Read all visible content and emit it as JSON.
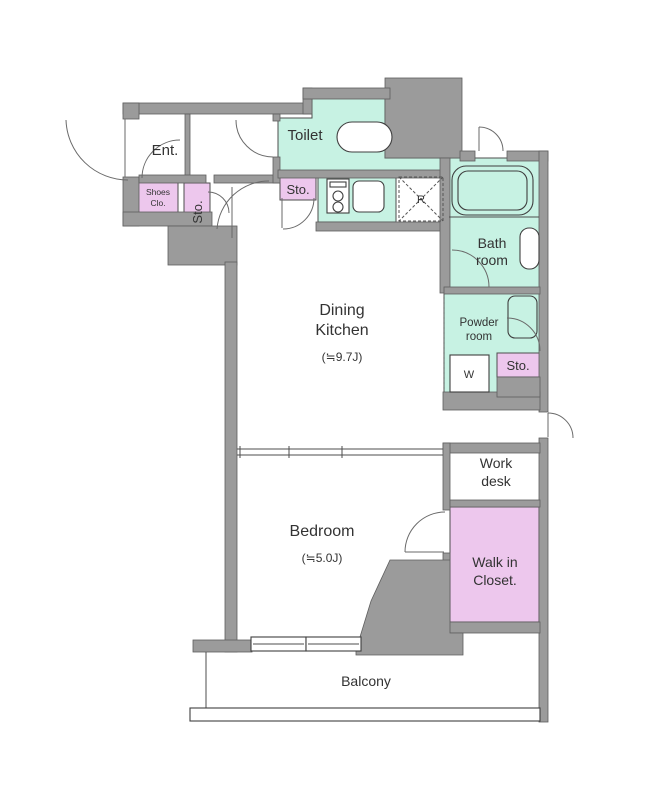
{
  "title": "1DK apartment floor plan",
  "colors": {
    "wall": "#9b9b9b",
    "room_teal": "#c7f2e3",
    "room_pink": "#edc7ed",
    "white": "#ffffff",
    "outline": "#4d4d4d",
    "text": "#333333"
  },
  "rooms": {
    "entrance": {
      "label": "Ent."
    },
    "shoes_closet": {
      "label_line1": "Shoes",
      "label_line2": "Clo."
    },
    "storage_entrance": {
      "label": "Sto."
    },
    "toilet": {
      "label": "Toilet"
    },
    "storage_kitchen": {
      "label": "Sto."
    },
    "refrigerator_space": {
      "label": "R"
    },
    "bath": {
      "label_line1": "Bath",
      "label_line2": "room"
    },
    "powder": {
      "label_line1": "Powder",
      "label_line2": "room"
    },
    "washer_space": {
      "label": "W"
    },
    "storage_powder": {
      "label": "Sto."
    },
    "dining_kitchen": {
      "label_line1": "Dining",
      "label_line2": "Kitchen",
      "area": "(≒9.7J)"
    },
    "bedroom": {
      "label": "Bedroom",
      "area": "(≒5.0J)"
    },
    "work_desk": {
      "label_line1": "Work",
      "label_line2": "desk"
    },
    "walk_in_closet": {
      "label_line1": "Walk in",
      "label_line2": "Closet."
    },
    "balcony": {
      "label": "Balcony"
    }
  }
}
